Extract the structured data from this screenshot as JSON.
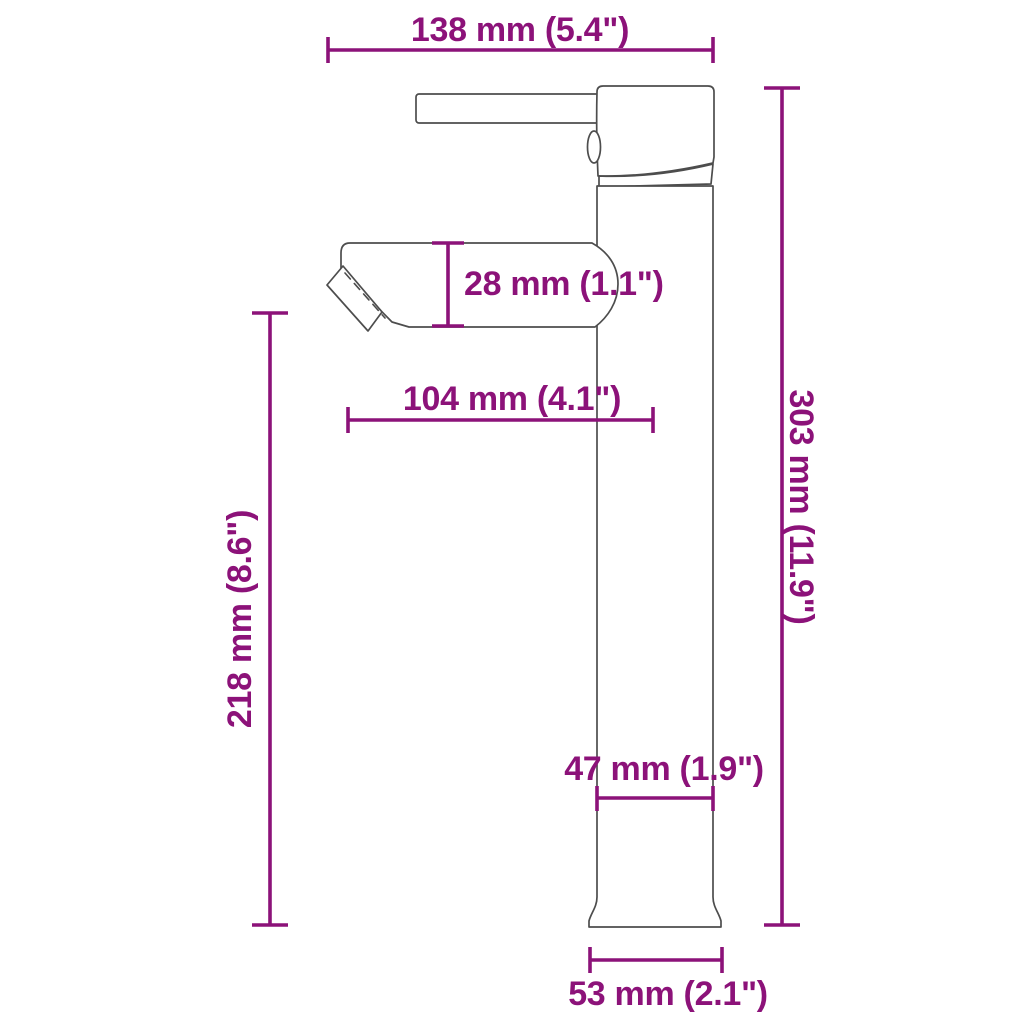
{
  "diagram": {
    "name": "faucet-dimension-drawing",
    "subject": "tall single-handle basin faucet, side view line drawing",
    "colors": {
      "dimension_annotation": "#8c1279",
      "product_outline": "#4d4d4d",
      "background": "#ffffff"
    },
    "dimensions": {
      "top_width": {
        "label": "138 mm (5.4\")",
        "mm": 138,
        "inches": 5.4
      },
      "spout_height": {
        "label": "28 mm (1.1\")",
        "mm": 28,
        "inches": 1.1
      },
      "spout_reach": {
        "label": "104 mm (4.1\")",
        "mm": 104,
        "inches": 4.1
      },
      "outlet_height": {
        "label": "218 mm (8.6\")",
        "mm": 218,
        "inches": 8.6
      },
      "total_height": {
        "label": "303 mm (11.9\")",
        "mm": 303,
        "inches": 11.9
      },
      "body_width": {
        "label": "47 mm (1.9\")",
        "mm": 47,
        "inches": 1.9
      },
      "base_width": {
        "label": "53 mm (2.1\")",
        "mm": 53,
        "inches": 2.1
      }
    }
  }
}
